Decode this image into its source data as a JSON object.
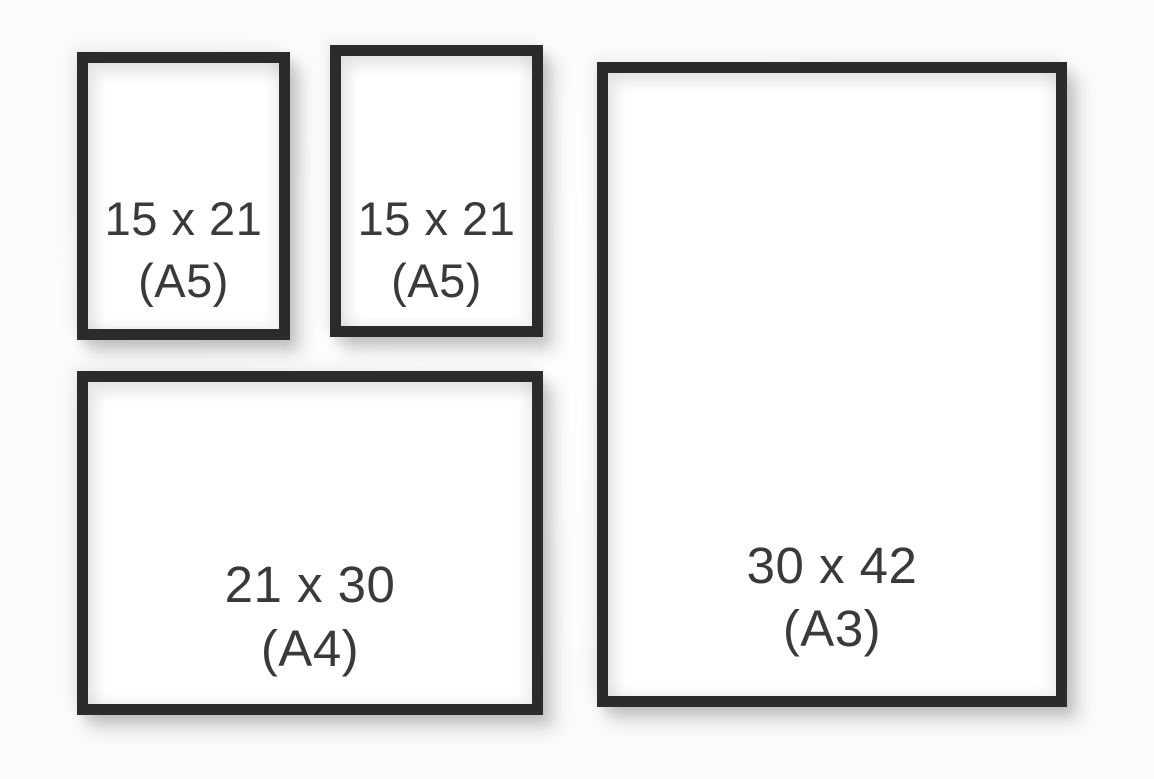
{
  "colors": {
    "background": "#fbfbfb",
    "frame_border": "#2b2b2b",
    "paper": "#ffffff",
    "label_text": "#3a3a3a"
  },
  "frames": [
    {
      "name": "small-portrait-frame-top-left",
      "size_label": "15 x 21",
      "format_label": "(A5)"
    },
    {
      "name": "small-portrait-frame-top-middle",
      "size_label": "15 x 21",
      "format_label": "(A5)"
    },
    {
      "name": "large-portrait-frame-right",
      "size_label": "30 x 42",
      "format_label": "(A3)"
    },
    {
      "name": "landscape-frame-bottom-left",
      "size_label": "21 x 30",
      "format_label": "(A4)"
    }
  ]
}
